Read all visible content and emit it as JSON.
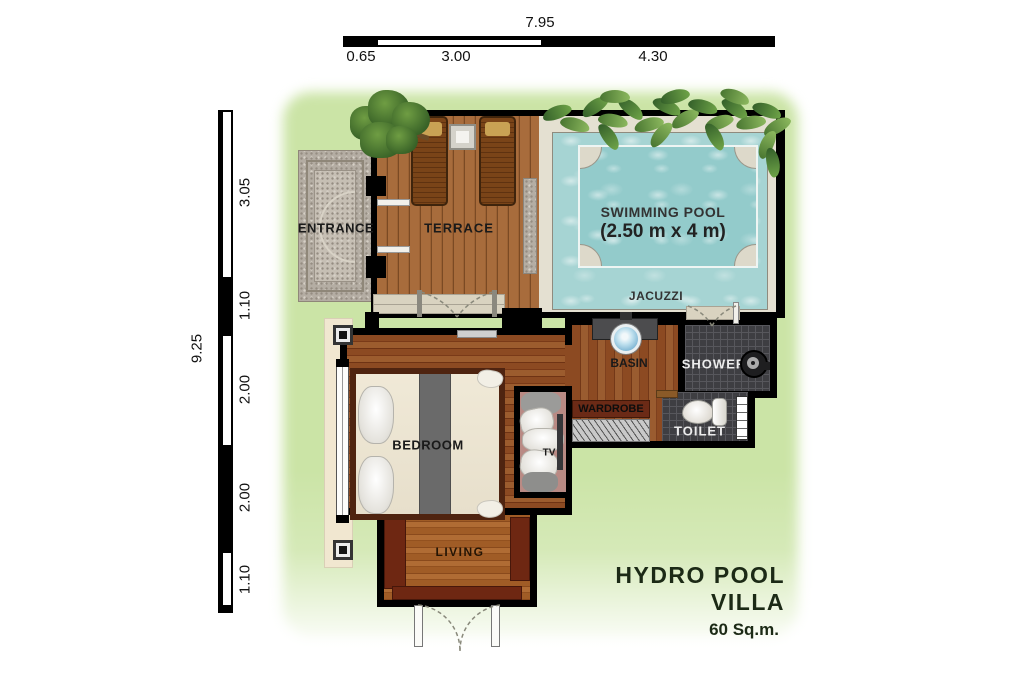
{
  "plan": {
    "rooms": {
      "entrance": "ENTRANCE",
      "terrace": "TERRACE",
      "swimming_pool_line1": "SWIMMING POOL",
      "swimming_pool_line2": "(2.50 m x 4 m)",
      "jacuzzi": "JACUZZI",
      "basin": "BASIN",
      "shower": "SHOWER",
      "wardrobe": "WARDROBE",
      "toilet": "TOILET",
      "bedroom": "BEDROOM",
      "tv": "TV",
      "living": "LIVING"
    },
    "title": {
      "name": "HYDRO POOL VILLA",
      "area": "60 Sq.m."
    },
    "dimensions": {
      "top": {
        "total": "7.95",
        "segments": [
          "0.65",
          "3.00",
          "4.30"
        ]
      },
      "left": {
        "total": "9.25",
        "segments": [
          "3.05",
          "1.10",
          "2.00",
          "2.00",
          "1.10"
        ]
      }
    },
    "colors": {
      "lawn": "#cbe4a6",
      "pool_water": "#a6d4d3",
      "pool_inner": "#93cbcb",
      "deck": "#e4e0d1",
      "terrace_wood": "#a2683a",
      "floor_wood": "#8a4a22",
      "living_wood": "#9c5a26",
      "dark_tile": "#3e3e42",
      "sofa": "#6e2712",
      "wall": "#000000",
      "stone": "#b4ada3",
      "patio": "#f1e7d0"
    }
  }
}
